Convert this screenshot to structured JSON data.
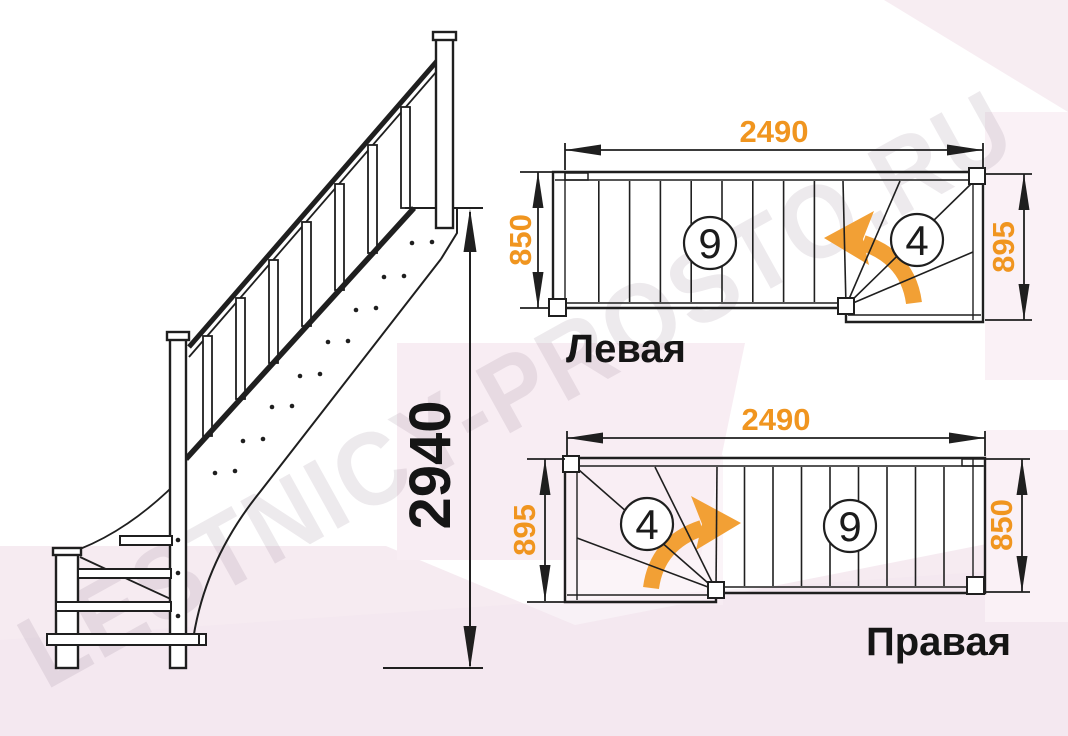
{
  "watermark": "LESTNICY-PROSTO.RU",
  "colors": {
    "accent_orange": "#F0951F",
    "line_color": "#1F1F1F",
    "background_pink": "#F6EBF1"
  },
  "elevation": {
    "height": "2940"
  },
  "plan_left": {
    "title": "Левая",
    "length": "2490",
    "flight_width": "850",
    "turn_width": "895",
    "straight_steps": "9",
    "winder_steps": "4"
  },
  "plan_right": {
    "title": "Правая",
    "length": "2490",
    "flight_width": "850",
    "turn_width": "895",
    "straight_steps": "9",
    "winder_steps": "4"
  }
}
